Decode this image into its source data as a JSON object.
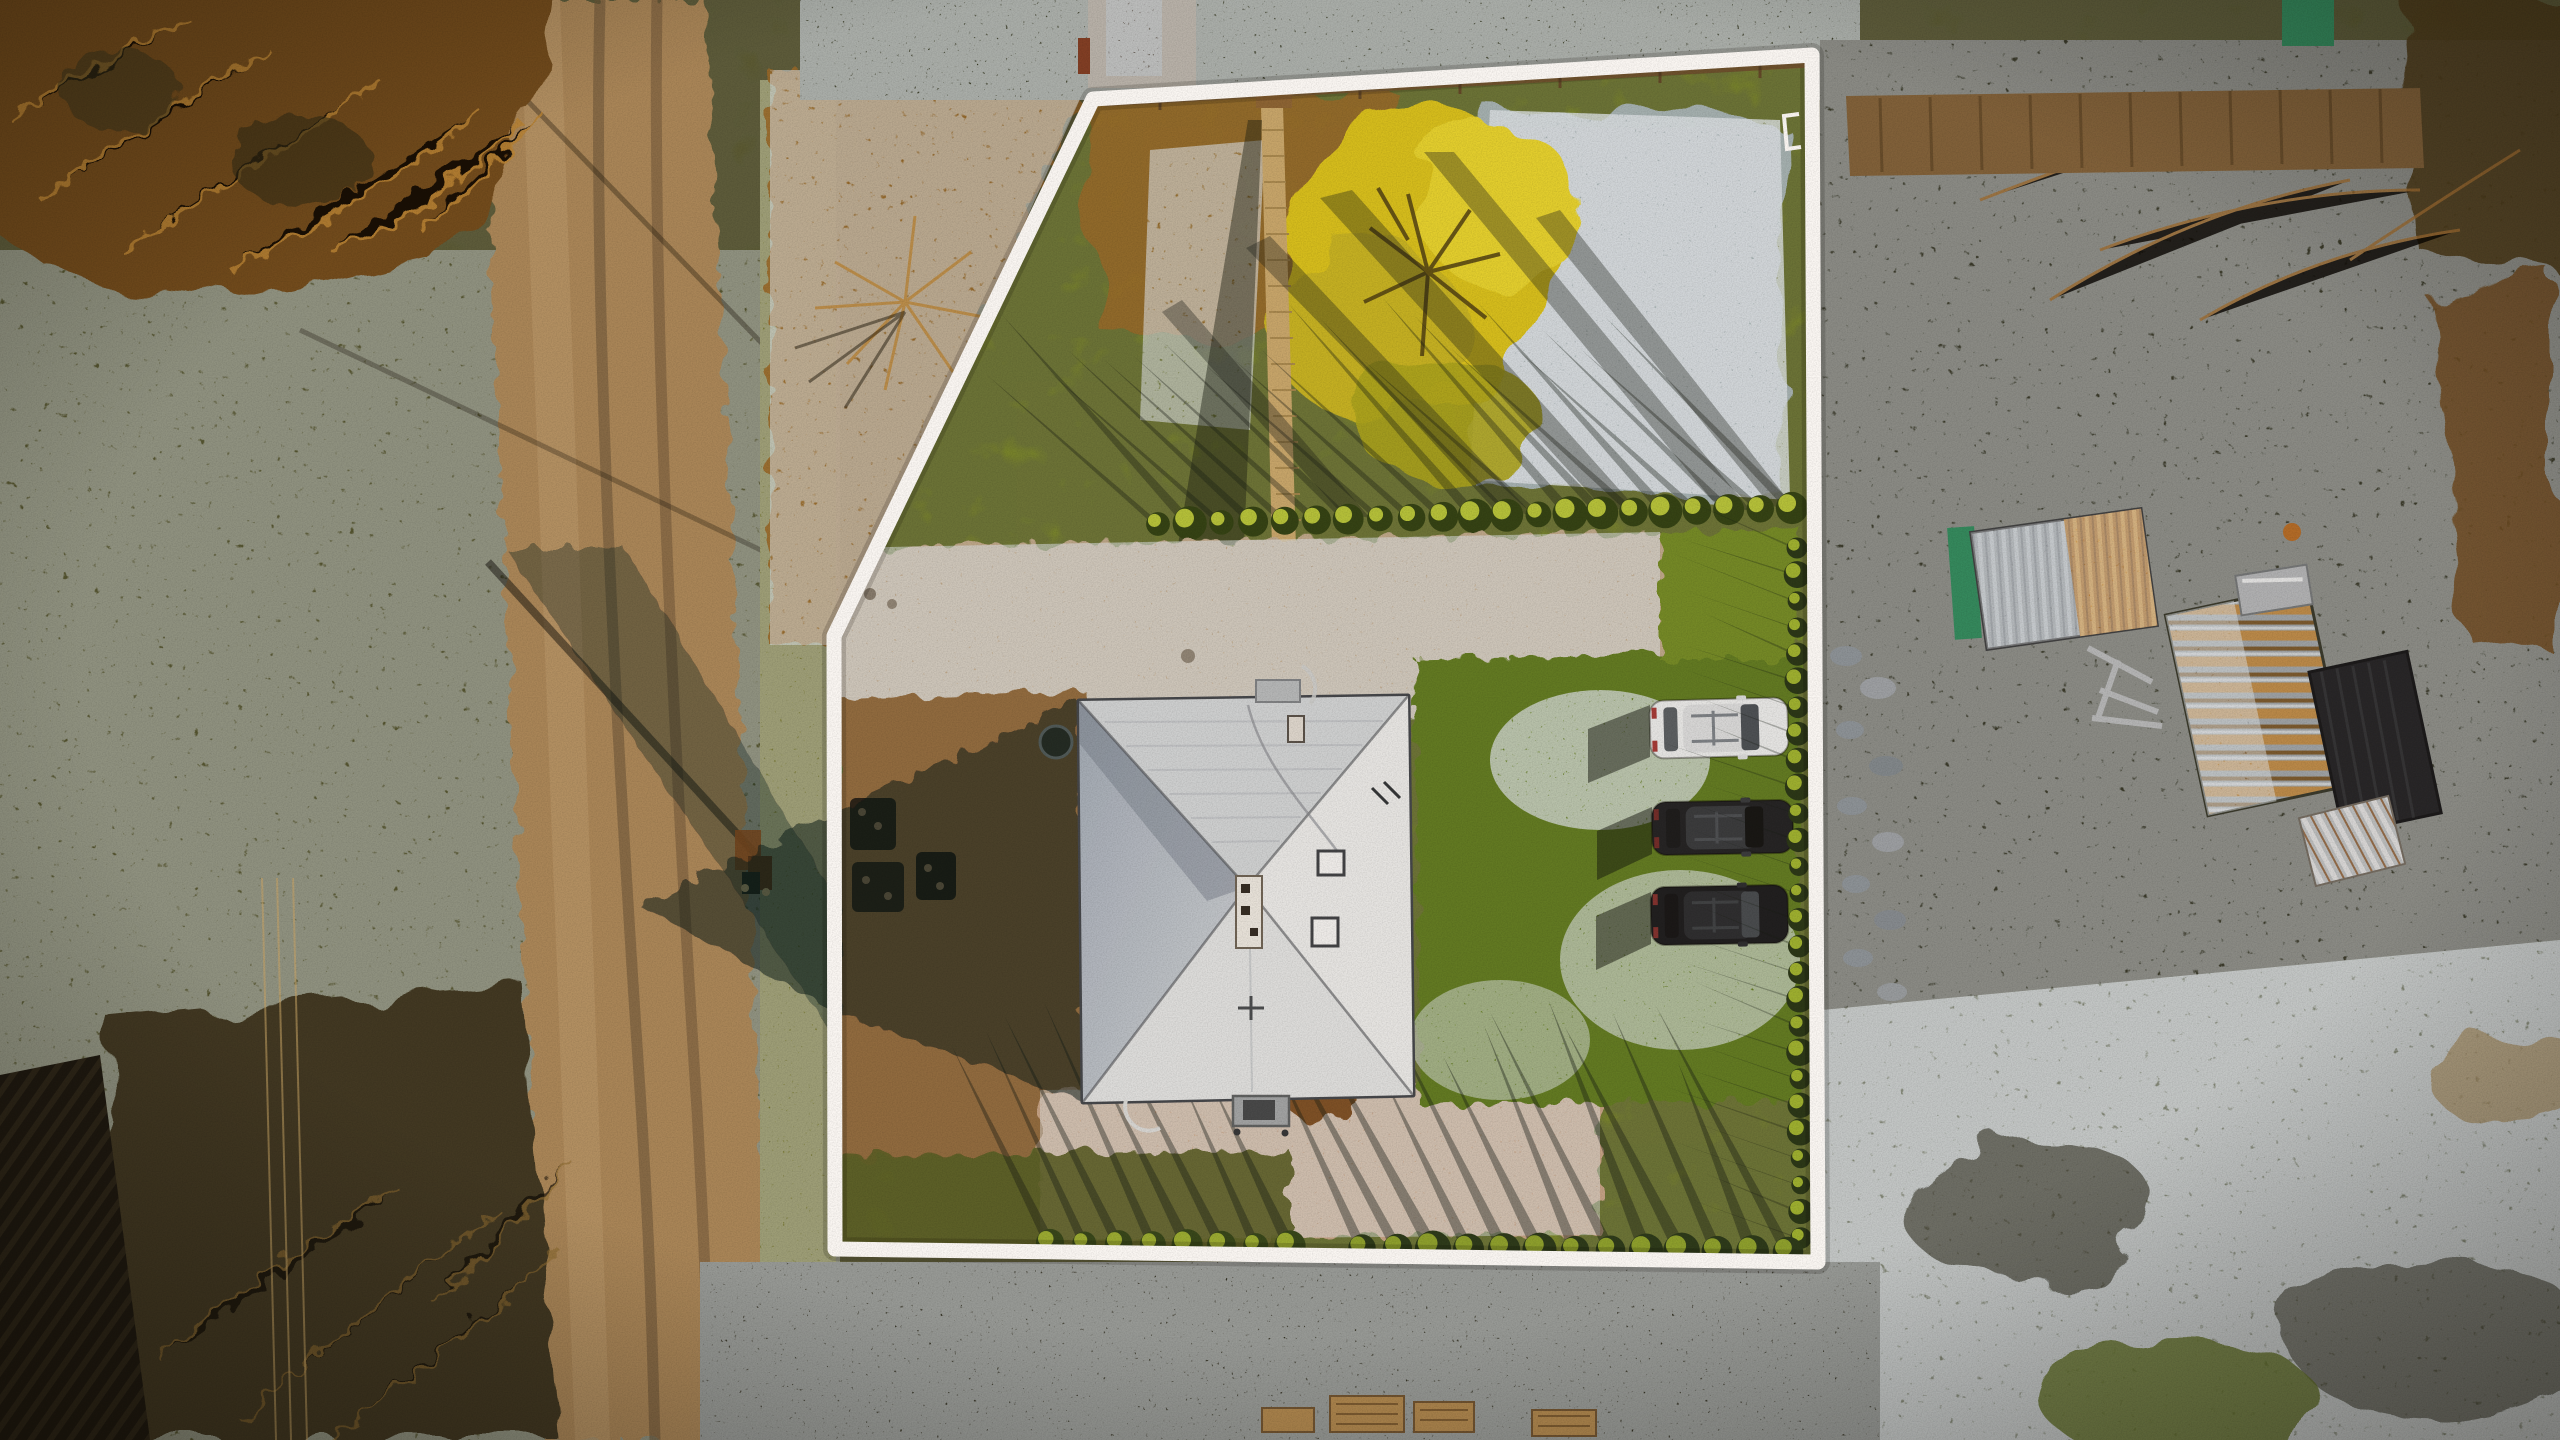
{
  "meta": {
    "type": "aerial-drone-photograph",
    "description": "Top-down drone photo of a rural homestead plot in late autumn with first frost, golden-hour light from the east. A white property-boundary polygon is drawn over the photo around the plot.",
    "width_px": 2560,
    "height_px": 1440,
    "visible_text": "none"
  },
  "overlay": {
    "boundary_points": "834,636 1093,99 1812,55 1818,1262 835,1249",
    "boundary_stroke": "#fdfdfd",
    "boundary_width": 15,
    "halo_rgba": "rgba(0,0,0,0.16)",
    "gate_bracket_path": "M 1799 114 L 1784 116 L 1787 149 L 1801 147"
  },
  "palette": {
    "base_field": "#565832",
    "road": "#a8865a",
    "road_shade": "#6d583c",
    "grass_plot": "#74842c",
    "grass_lit": "#7a8a2e",
    "leaf_litter": "#96682a",
    "frost": "#a9b8c4",
    "canopy_yellow": "#d6c01c",
    "canopy_yellow_hi": "#e4d22f",
    "autumn_tree": "#6e4a1d",
    "autumn_gold": "#b98434",
    "gravel": "#bba78c",
    "dirt": "#8e6a40",
    "shadow": "rgba(12,16,20,0.52)",
    "hedge_dark": "#2e4014",
    "hedge_light": "#c3d13e",
    "roof_north": "#ced3d7",
    "roof_east": "#e7e9ea",
    "roof_south": "#dee1e3",
    "roof_west_light": "#c9d0d7",
    "roof_west_dark": "#a2adba",
    "roof_edge": "#3f444b",
    "shed_gray": "#a7aeb5",
    "shed_orange": "#c08136",
    "barn_tan": "#b98a4a",
    "shed_dark": "#202227",
    "teal_fence": "#2e8a5f",
    "path_stone": "#c7a76d",
    "fence_wood": "#7d5e36",
    "pallet_wood": "#b08a52",
    "dark_zone": "#33362a",
    "bottom_right_frost_grass": "#7d8578",
    "plow_field": "#17150f"
  },
  "house": {
    "nw": [
      1079,
      701
    ],
    "ne": [
      1408,
      696
    ],
    "se": [
      1413,
      1095
    ],
    "sw": [
      1083,
      1102
    ],
    "peak": [
      1247,
      887
    ],
    "chimney": {
      "x": 1236,
      "y": 876,
      "w": 26,
      "h": 72,
      "fill": "#e8e6e1",
      "vent": "#2f2a24"
    },
    "top_chimney": {
      "x": 1288,
      "y": 716,
      "w": 16,
      "h": 26,
      "fill": "#ddd9d2"
    },
    "skylights": [
      [
        1318,
        851,
        26,
        24
      ],
      [
        1312,
        918,
        26,
        28
      ]
    ],
    "north_canopy": {
      "x": 1256,
      "y": 680,
      "w": 44,
      "h": 22,
      "fill": "#b4b9bd"
    },
    "south_canopy": {
      "x": 1233,
      "y": 1096,
      "w": 56,
      "h": 30,
      "fill": "#9fa4a8"
    }
  },
  "hedge_rows": [
    {
      "target": "hedge-garden",
      "x1": 1158,
      "y1": 524,
      "x2": 1792,
      "y2": 508,
      "count": 21,
      "r": 14,
      "dark": "#2e4014",
      "light": "#c3d13e",
      "shadow": {
        "dx": -150,
        "dy": -135,
        "w": 17,
        "opacity": 0.36,
        "jitter": 70
      }
    },
    {
      "target": "hedge-right",
      "x1": 1797,
      "y1": 548,
      "x2": 1801,
      "y2": 1238,
      "count": 27,
      "r": 11,
      "dark": "#243417",
      "light": "#a9bf33",
      "shadow": {
        "dx": -98,
        "dy": -30,
        "w": 13,
        "opacity": 0.3,
        "jitter": 45
      }
    },
    {
      "target": "hedge-bottom-a",
      "x1": 1050,
      "y1": 1243,
      "x2": 1290,
      "y2": 1246,
      "count": 8,
      "r": 13,
      "dark": "#31441a",
      "light": "#a4b835",
      "shadow": {
        "dx": -80,
        "dy": -168,
        "w": 15,
        "opacity": 0.4,
        "jitter": 30
      }
    },
    {
      "target": "hedge-bottom-b",
      "x1": 1362,
      "y1": 1248,
      "x2": 1788,
      "y2": 1252,
      "count": 13,
      "r": 15,
      "dark": "#26371a",
      "light": "#97ad30",
      "shadow": {
        "dx": -88,
        "dy": -178,
        "w": 16,
        "opacity": 0.4,
        "jitter": 50
      }
    }
  ],
  "cars": [
    {
      "name": "white-sedan",
      "x": 1650,
      "y": 699,
      "w": 138,
      "h": 58,
      "angle": -1.5,
      "body": "#e6e9eb",
      "roof": "#d7dbde",
      "glass": "#474e56",
      "rear_glass": "#565d64",
      "tail": "#a23737",
      "rack": "#6f767e",
      "shadow_dx": -62
    },
    {
      "name": "dark-gray-suv",
      "x": 1652,
      "y": 801,
      "w": 141,
      "h": 53,
      "angle": -1,
      "body": "#1e2024",
      "roof": "#34383e",
      "glass": "#101214",
      "rear_glass": "#17191c",
      "tail": "#6e2a2a",
      "rack": "#4a5057",
      "shadow_dx": -55
    },
    {
      "name": "black-hatchback",
      "x": 1651,
      "y": 886,
      "w": 137,
      "h": 58,
      "angle": -1,
      "body": "#191b1f",
      "roof": "#282b30",
      "glass": "#434950",
      "rear_glass": "#121417",
      "tail": "#7e2f2f",
      "rack": "#3c4248",
      "shadow_dx": -55
    }
  ],
  "power_lines": {
    "x": [
      262,
      277,
      293
    ],
    "y1": 878,
    "y2": 1440,
    "stroke": "#c9a86a"
  },
  "garden": {
    "path": {
      "x_top": 1261,
      "y_top": 106,
      "x_bottom": 1285,
      "y_bottom": 548,
      "width": 22,
      "fill": "#c7a76d"
    },
    "fence_from": [
      1105,
      102
    ],
    "fence_to": [
      1810,
      63
    ],
    "tree_canopy_center": [
      1420,
      258
    ],
    "frost_patch": [
      1490,
      110,
      1760,
      500
    ]
  },
  "objects": [
    {
      "name": "well-cover",
      "cx": 1056,
      "cy": 742,
      "r": 15
    },
    {
      "name": "wood-log-piles",
      "x": 850,
      "y": 795,
      "w": 130,
      "h": 180
    },
    {
      "name": "orange-equipment",
      "x": 735,
      "y": 830,
      "w": 40,
      "h": 62
    },
    {
      "name": "dirt-mound-log-heap",
      "x": 1288,
      "y": 1062,
      "w": 66,
      "h": 60
    },
    {
      "name": "pallets-lumber",
      "rects": [
        [
          1330,
          1396,
          74,
          36
        ],
        [
          1414,
          1402,
          60,
          30
        ],
        [
          1532,
          1410,
          64,
          26
        ],
        [
          1262,
          1408,
          52,
          24
        ]
      ]
    },
    {
      "name": "barrel",
      "cx": 2292,
      "cy": 532,
      "r": 9
    }
  ],
  "sheds": [
    {
      "name": "two-tone-roof-shed",
      "x": 1978,
      "y": 520,
      "w": 172,
      "h": 118,
      "angle": -8
    },
    {
      "name": "corrugated-barn",
      "x": 2185,
      "y": 598,
      "w": 145,
      "h": 205,
      "angle": -12
    },
    {
      "name": "dark-roof-shed",
      "x": 2325,
      "y": 660,
      "w": 100,
      "h": 165,
      "angle": -12
    },
    {
      "name": "corrugated-panel",
      "x": 2306,
      "y": 806,
      "w": 92,
      "h": 70,
      "angle": -14
    },
    {
      "name": "gray-cabinet",
      "x": 2238,
      "y": 570,
      "w": 72,
      "h": 40,
      "angle": -9
    }
  ]
}
